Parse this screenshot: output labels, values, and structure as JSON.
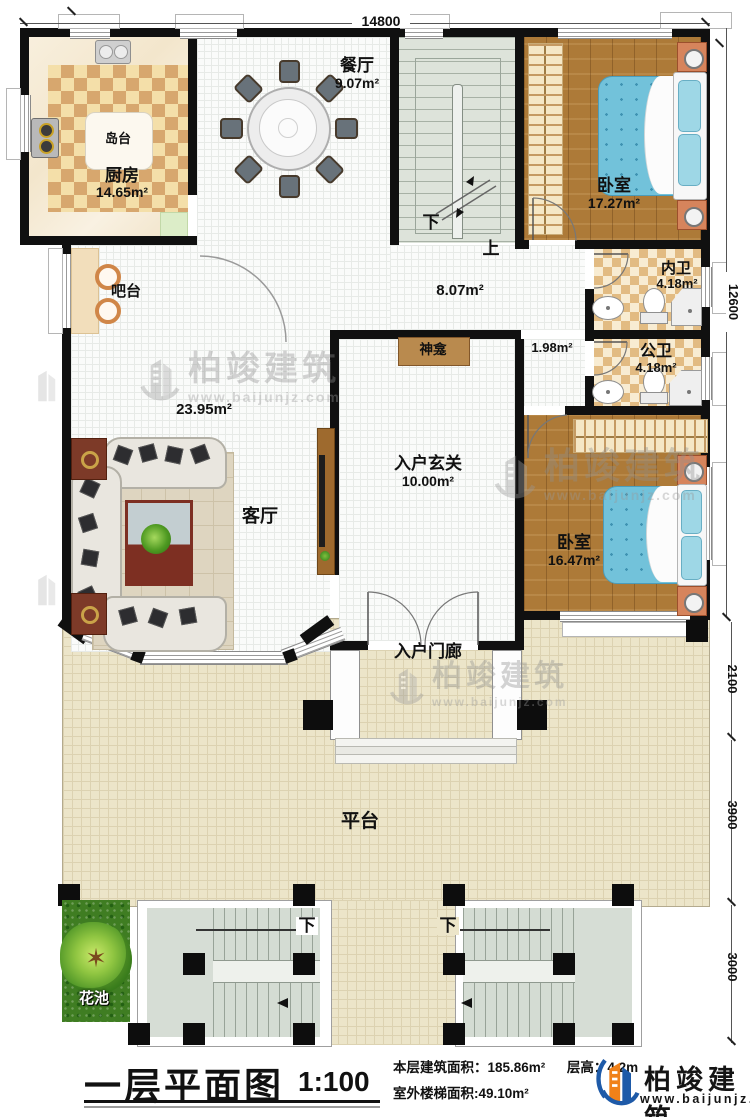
{
  "dims": {
    "top": "14800",
    "right_total": "12600",
    "right_porch": "2100",
    "right_platform": "3900",
    "right_stairs": "3000"
  },
  "rooms": {
    "kitchen": {
      "name": "厨房",
      "area": "14.65m²"
    },
    "island": {
      "name": "岛台"
    },
    "dining": {
      "name": "餐厅",
      "area": "9.07m²"
    },
    "bar": {
      "name": "吧台"
    },
    "bedroom1": {
      "name": "卧室",
      "area": "17.27m²"
    },
    "innerbath": {
      "name": "内卫",
      "area": "4.18m²"
    },
    "publicbath": {
      "name": "公卫",
      "area": "4.18m²"
    },
    "hallway": {
      "area": "8.07m²"
    },
    "corridor": {
      "area": "1.98m²"
    },
    "shrine": {
      "name": "神龛"
    },
    "living": {
      "name": "客厅",
      "area": "23.95m²"
    },
    "foyer": {
      "name": "入户玄关",
      "area": "10.00m²"
    },
    "bedroom2": {
      "name": "卧室",
      "area": "16.47m²"
    },
    "porch": {
      "name": "入户门廊"
    },
    "platform": {
      "name": "平台"
    },
    "flowerbed": {
      "name": "花池"
    }
  },
  "stairs": {
    "down": "下",
    "up": "上"
  },
  "watermark": {
    "brand": "柏竣建筑",
    "url": "www.baijunjz.com"
  },
  "footer": {
    "title": "一层平面图",
    "scale": "1:100",
    "area_label": "本层建筑面积：",
    "area_value": "185.86m²",
    "height_label": "层高：",
    "height_value": "4.2m",
    "stair_label": "室外楼梯面积:",
    "stair_value": "49.10m²",
    "brand": "柏竣建筑",
    "url": "www.baijunjz.com"
  },
  "colors": {
    "wall": "#101010",
    "wood_floor": "#ad7a38",
    "bed_blue": "#72c2da",
    "checker_tan": "#d7a76e",
    "logo_orange": "#f08119",
    "logo_blue": "#1e5aa8"
  }
}
